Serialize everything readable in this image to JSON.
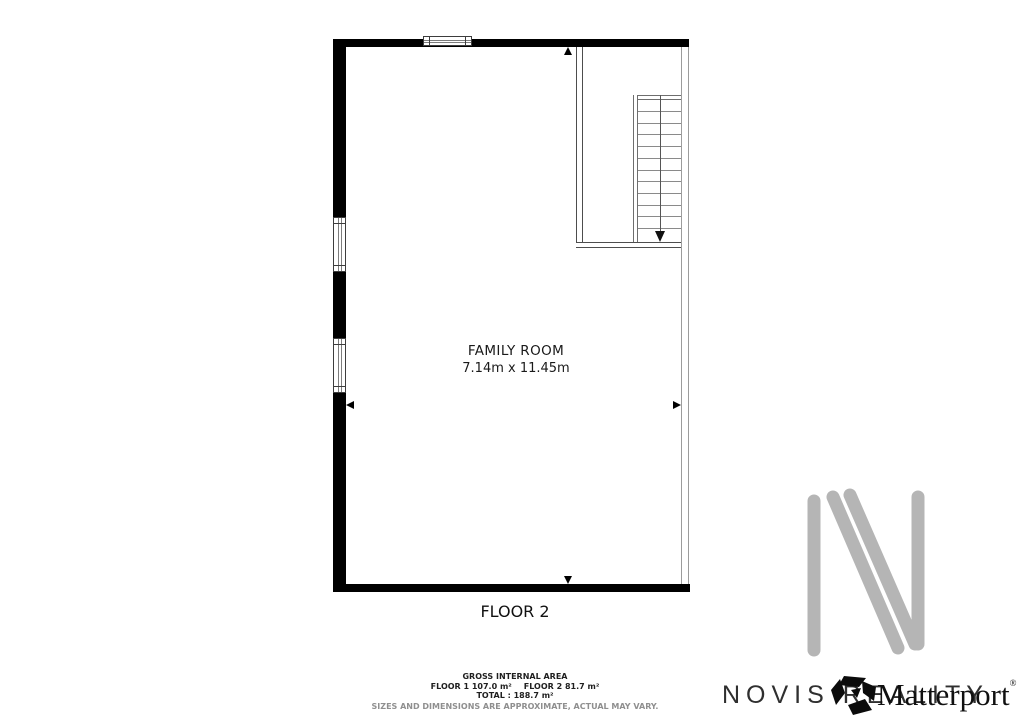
{
  "floor_plan": {
    "room": {
      "name": "FAMILY ROOM",
      "dimensions": "7.14m x 11.45m"
    },
    "floor_label": "FLOOR 2",
    "stairs": {
      "visible_treads": 11,
      "direction": "down"
    }
  },
  "footer": {
    "title": "GROSS INTERNAL AREA",
    "floor1_area": "FLOOR 1 107.0 m²",
    "floor2_area": "FLOOR 2 81.7 m²",
    "total_line": "TOTAL :  188.7 m²",
    "disclaimer": "SIZES AND DIMENSIONS ARE APPROXIMATE, ACTUAL MAY VARY."
  },
  "branding": {
    "agency_name": "NOVIS REALITY",
    "matterport_label": "Matterport",
    "registered_mark": "®",
    "logo_gray": "#b5b5b5"
  }
}
